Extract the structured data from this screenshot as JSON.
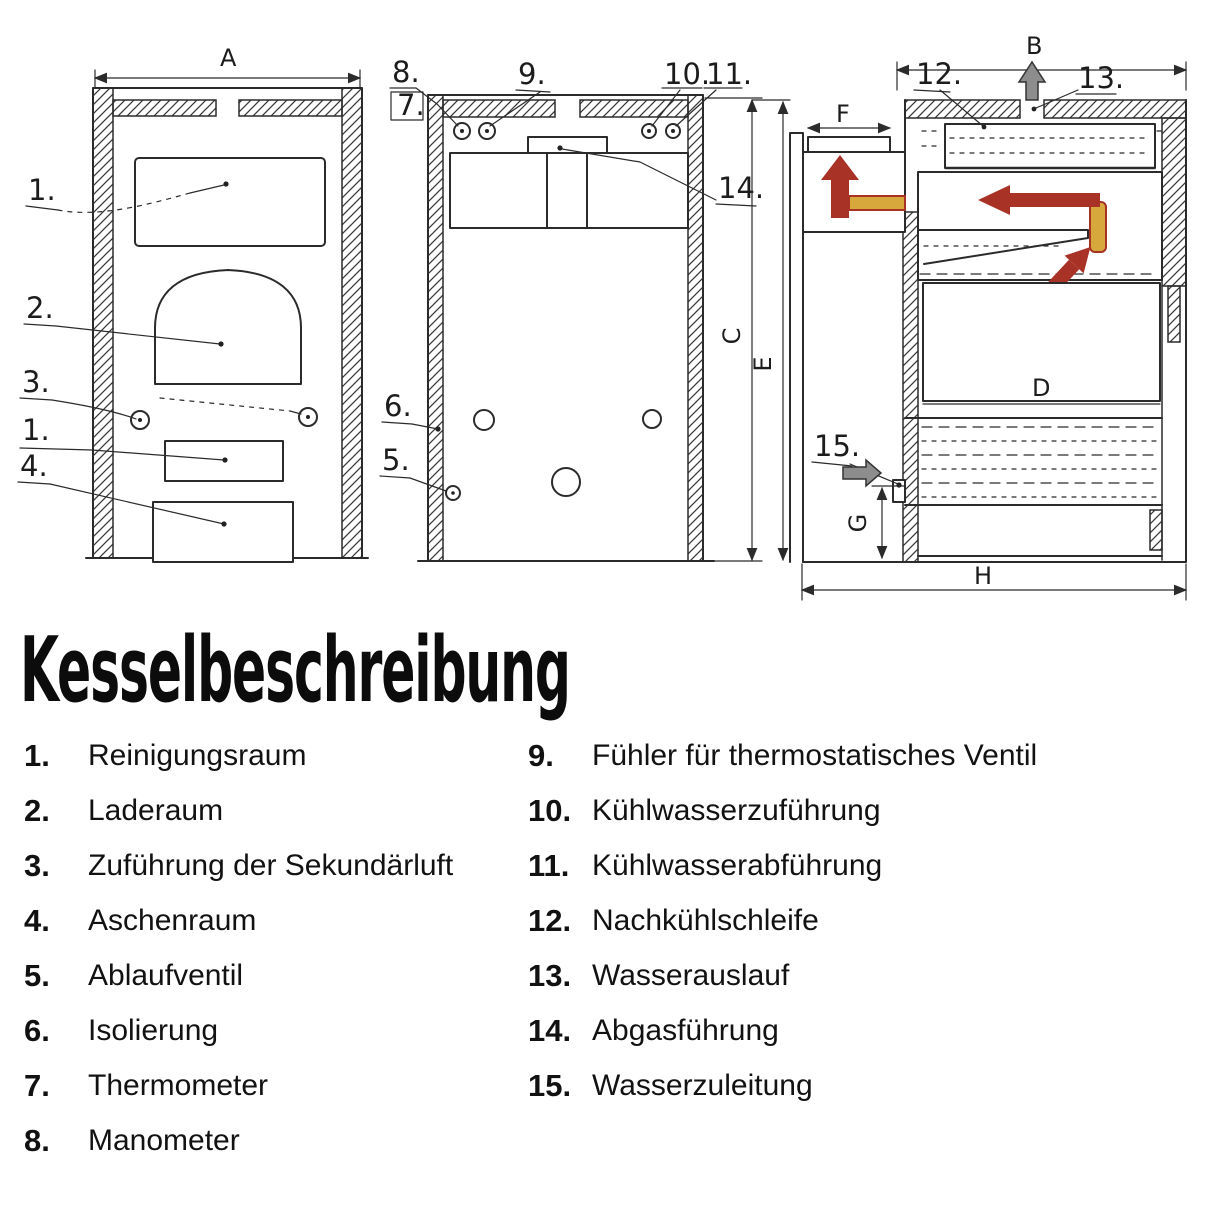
{
  "page": {
    "title": "Kesselbeschreibung"
  },
  "diagram": {
    "dimensions": {
      "A": "A",
      "B": "B",
      "C": "C",
      "D": "D",
      "E": "E",
      "F": "F",
      "G": "G",
      "H": "H"
    },
    "front_view_callouts": [
      "1.",
      "2.",
      "3.",
      "1.",
      "4."
    ],
    "rear_view_callouts": [
      "8.",
      "7.",
      "9.",
      "10.",
      "11.",
      "14.",
      "6.",
      "5."
    ],
    "side_view_callouts": [
      "12.",
      "13.",
      "15."
    ],
    "colors": {
      "ink": "#2b2b2b",
      "flow_arrow_red": "#a83226",
      "pipe_yellow": "#d7a93c",
      "cold_arrow_gray": "#8d8d8d"
    }
  },
  "parts_list": {
    "left": [
      {
        "num": "1.",
        "label": "Reinigungsraum"
      },
      {
        "num": "2.",
        "label": "Laderaum"
      },
      {
        "num": "3.",
        "label": "Zuführung der Sekundärluft"
      },
      {
        "num": "4.",
        "label": "Aschenraum"
      },
      {
        "num": "5.",
        "label": "Ablaufventil"
      },
      {
        "num": "6.",
        "label": "Isolierung"
      },
      {
        "num": "7.",
        "label": "Thermometer"
      },
      {
        "num": "8.",
        "label": "Manometer"
      }
    ],
    "right": [
      {
        "num": "9.",
        "label": "Fühler für thermostatisches Ventil"
      },
      {
        "num": "10.",
        "label": "Kühlwasserzuführung"
      },
      {
        "num": "11.",
        "label": "Kühlwasserabführung"
      },
      {
        "num": "12.",
        "label": "Nachkühlschleife"
      },
      {
        "num": "13.",
        "label": "Wasserauslauf"
      },
      {
        "num": "14.",
        "label": "Abgasführung"
      },
      {
        "num": "15.",
        "label": "Wasserzuleitung"
      }
    ]
  }
}
